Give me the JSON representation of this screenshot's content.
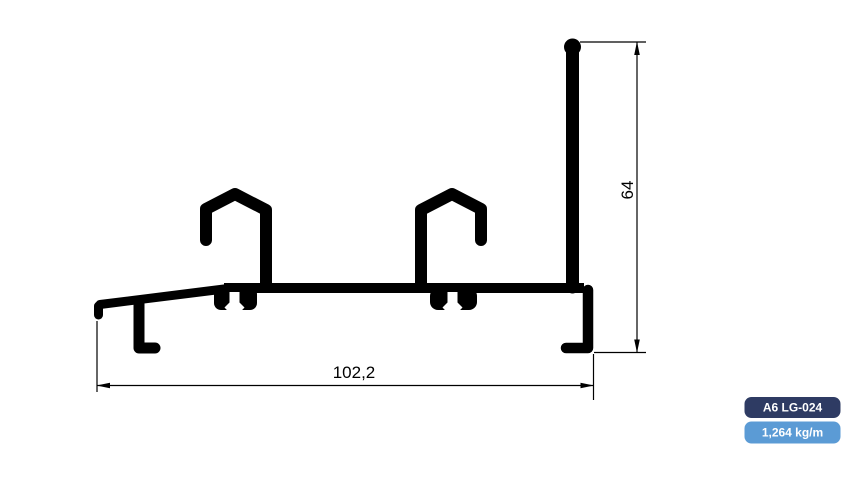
{
  "page": {
    "background": "#ffffff"
  },
  "drawing": {
    "name": "aluminium-extrusion-profile-cross-section",
    "stroke_color": "#000000",
    "dimensions": {
      "width": {
        "label": "102,2"
      },
      "height": {
        "label": "64"
      }
    }
  },
  "badges": {
    "text_color": "#ffffff",
    "code": {
      "label": "A6 LG-024",
      "bg": "#2e3b63"
    },
    "weight": {
      "label": "1,264 kg/m",
      "bg": "#5b9bd5"
    }
  }
}
